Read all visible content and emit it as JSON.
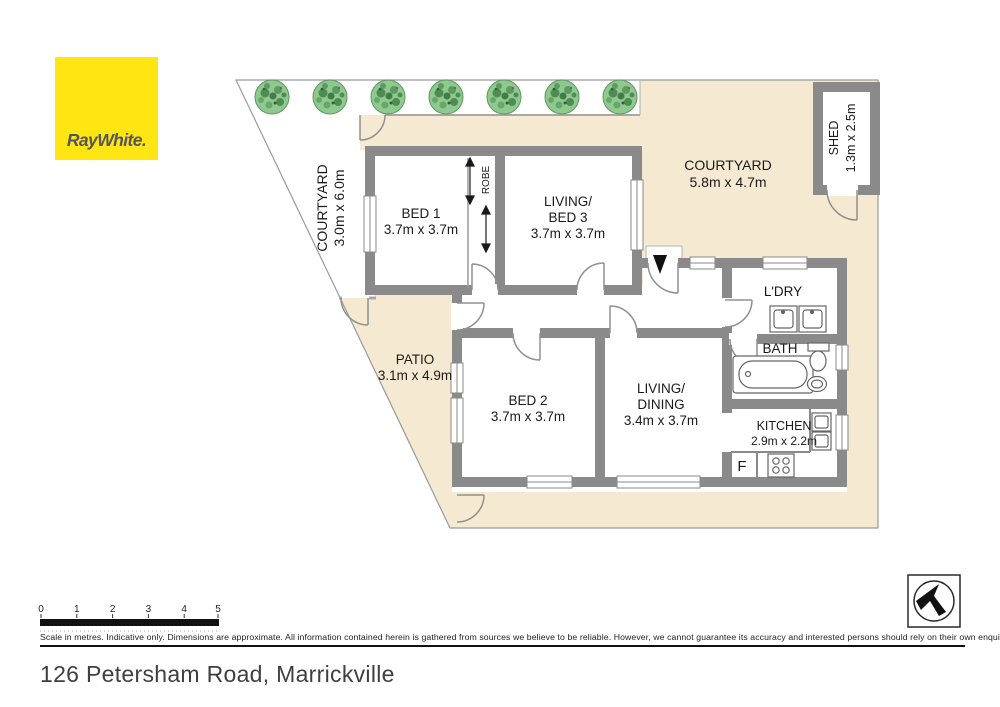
{
  "logo": {
    "text": "RayWhite."
  },
  "plan": {
    "areas": {
      "courtyard_left": {
        "lines": [
          "COURTYARD",
          "3.0m x 6.0m"
        ]
      },
      "courtyard_right": {
        "lines": [
          "COURTYARD",
          "5.8m x 4.7m"
        ]
      },
      "patio": {
        "lines": [
          "PATIO",
          "3.1m x 4.9m"
        ]
      },
      "shed": {
        "lines": [
          "SHED",
          "1.3m x 2.5m"
        ]
      },
      "bed1": {
        "lines": [
          "BED 1",
          "3.7m x 3.7m"
        ]
      },
      "living_bed3": {
        "lines": [
          "LIVING/",
          "BED 3",
          "3.7m x 3.7m"
        ]
      },
      "bed2": {
        "lines": [
          "BED 2",
          "3.7m x 3.7m"
        ]
      },
      "living_dining": {
        "lines": [
          "LIVING/",
          "DINING",
          "3.4m x 3.7m"
        ]
      },
      "ldry": {
        "label": "L'DRY"
      },
      "bath": {
        "label": "BATH"
      },
      "kitchen": {
        "lines": [
          "KITCHEN",
          "2.9m x 2.2m"
        ]
      },
      "robe": {
        "label": "ROBE"
      },
      "fridge": {
        "label": "F"
      }
    },
    "colors": {
      "logo_yellow": "#FFE512",
      "yard_cream": "#F5EAD1",
      "wall_gray": "#8A8A8A",
      "tree_green": "#8FC98F"
    }
  },
  "scalebar": {
    "labels": [
      "0",
      "1",
      "2",
      "3",
      "4",
      "5"
    ]
  },
  "disclaimer": "Scale in metres. Indicative only. Dimensions are approximate. All information contained herein is gathered from sources we believe to be reliable. However, we cannot guarantee its accuracy and interested persons should rely on their own enquiries.",
  "address": "126 Petersham Road, Marrickville"
}
